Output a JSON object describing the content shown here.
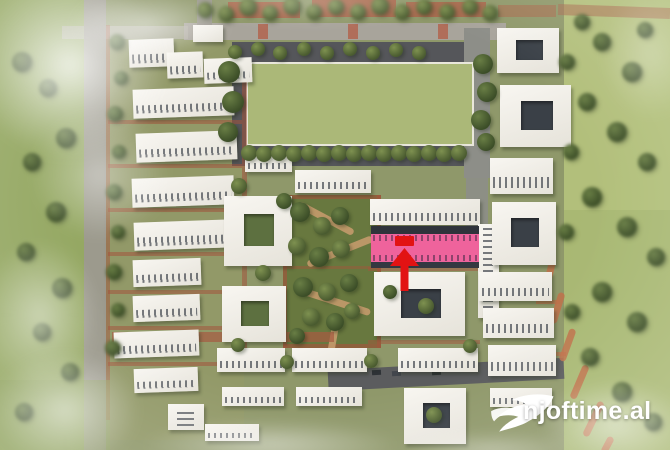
{
  "watermark": {
    "text": "njoftime.al",
    "logo": "bird-swoosh-icon",
    "color": "#ffffff"
  },
  "highlight": {
    "building_color": "#ef639c",
    "marker_color": "#e21313",
    "meaning": "highlighted-building-with-red-arrow-marker"
  },
  "palette": {
    "grass": "#9aab68",
    "sports_field": "#abb878",
    "pavement": "#55565a",
    "building_white": "#f4f1ea",
    "facade_dark": "#2f333b",
    "path_red": "#a3543c",
    "watermark_text": "#ffffff"
  },
  "scene": {
    "description": "aerial 3D render of a residential complex master plan; white apartment slabs and courtyard blocks around a central garden and a green sports field; one long building highlighted pink with a red arrow; blurred green meadows at the edges",
    "patches": [
      [
        0,
        0,
        96,
        450,
        "#95a763",
        0.9
      ],
      [
        558,
        0,
        112,
        450,
        "#a8b873",
        0.9
      ],
      [
        556,
        0,
        114,
        210,
        "#b7c37f",
        0.65
      ],
      [
        104,
        0,
        460,
        450,
        "#8f986a",
        1
      ],
      [
        108,
        40,
        136,
        400,
        "#939a68",
        0.7
      ],
      [
        228,
        2,
        72,
        16,
        "#ad6148",
        0.85
      ],
      [
        312,
        0,
        84,
        17,
        "#ad6148",
        0.85
      ],
      [
        406,
        2,
        80,
        15,
        "#ad6148",
        0.8
      ],
      [
        498,
        5,
        58,
        12,
        "#ad6148",
        0.5
      ],
      [
        558,
        6,
        112,
        11,
        "#a96a4f",
        0.55,
        2
      ],
      [
        184,
        23,
        322,
        17,
        "#a8a49b",
        1
      ],
      [
        62,
        26,
        126,
        13,
        "#b6b2a8",
        0.65
      ],
      [
        197,
        0,
        15,
        25,
        "#9a978f",
        0.9
      ],
      [
        258,
        24,
        10,
        15,
        "#b2604a",
        0.8
      ],
      [
        348,
        24,
        10,
        15,
        "#b2604a",
        0.8
      ],
      [
        438,
        24,
        10,
        15,
        "#b2604a",
        0.8
      ],
      [
        232,
        42,
        252,
        124,
        "#55565a",
        1
      ],
      [
        464,
        28,
        26,
        150,
        "#8d8e88",
        1
      ],
      [
        466,
        176,
        22,
        56,
        "#8d8e88",
        0.9
      ],
      [
        84,
        0,
        22,
        450,
        "#9c998f",
        0.95
      ],
      [
        106,
        25,
        4,
        395,
        "#a3543c",
        0.5
      ],
      [
        246,
        62,
        224,
        80,
        "#abb878",
        1,
        0,
        0,
        "#e9e7db"
      ],
      [
        108,
        120,
        134,
        4,
        "#a3543c",
        0.55
      ],
      [
        108,
        164,
        134,
        4,
        "#a3543c",
        0.55
      ],
      [
        108,
        208,
        134,
        4,
        "#a3543c",
        0.55
      ],
      [
        108,
        252,
        134,
        4,
        "#a3543c",
        0.55
      ],
      [
        108,
        290,
        134,
        4,
        "#a3543c",
        0.55
      ],
      [
        108,
        326,
        134,
        4,
        "#a3543c",
        0.55
      ],
      [
        108,
        362,
        134,
        4,
        "#a3543c",
        0.55
      ],
      [
        242,
        58,
        5,
        300,
        "#a3543c",
        0.55
      ],
      [
        283,
        195,
        98,
        153,
        "#68783f",
        1
      ],
      [
        283,
        195,
        98,
        4,
        "#a3543c",
        0.65
      ],
      [
        283,
        344,
        98,
        4,
        "#a3543c",
        0.65
      ],
      [
        283,
        195,
        4,
        153,
        "#a3543c",
        0.65
      ],
      [
        377,
        195,
        4,
        153,
        "#a3543c",
        0.65
      ],
      [
        283,
        266,
        98,
        3,
        "#a3543c",
        0.45
      ],
      [
        295,
        215,
        62,
        7,
        "#c49a6c",
        0.9,
        28,
        4
      ],
      [
        305,
        248,
        70,
        7,
        "#c49a6c",
        0.9,
        -22,
        4
      ],
      [
        298,
        298,
        74,
        7,
        "#c49a6c",
        0.9,
        18,
        4
      ],
      [
        330,
        322,
        7,
        30,
        "#c49a6c",
        0.9,
        10,
        4
      ],
      [
        328,
        364,
        236,
        21,
        "#5b5c5e",
        1,
        -3
      ],
      [
        372,
        370,
        9,
        5,
        "#2e3236",
        1,
        -3
      ],
      [
        392,
        371,
        9,
        5,
        "#42464c",
        1,
        -3
      ],
      [
        432,
        370,
        9,
        5,
        "#2e3236",
        1,
        -3
      ],
      [
        112,
        332,
        222,
        10,
        "#a65a41",
        0.7
      ],
      [
        368,
        267,
        112,
        4,
        "#a3543c",
        0.5
      ],
      [
        368,
        340,
        112,
        4,
        "#a3543c",
        0.5
      ],
      [
        546,
        260,
        7,
        28,
        "#c0714a",
        0.85,
        14,
        4
      ],
      [
        554,
        292,
        7,
        32,
        "#c0714a",
        0.85,
        17,
        4
      ],
      [
        564,
        328,
        7,
        34,
        "#c0714a",
        0.85,
        20,
        4
      ],
      [
        576,
        364,
        7,
        36,
        "#c0714a",
        0.85,
        23,
        4
      ],
      [
        590,
        400,
        7,
        38,
        "#c0714a",
        0.85,
        26,
        4
      ],
      [
        604,
        436,
        7,
        18,
        "#c0714a",
        0.85,
        28,
        4
      ],
      [
        536,
        300,
        24,
        4,
        "#c0714a",
        0.7
      ],
      [
        540,
        352,
        26,
        4,
        "#c0714a",
        0.7
      ],
      [
        0,
        380,
        110,
        70,
        "#8d9f5e",
        0.5
      ]
    ],
    "buildings": [
      [
        193,
        25,
        30,
        17,
        "f",
        0
      ],
      [
        129,
        39,
        45,
        28,
        "s",
        -2
      ],
      [
        167,
        52,
        36,
        26,
        "s",
        -2
      ],
      [
        204,
        58,
        48,
        25,
        "s",
        -2
      ],
      [
        133,
        88,
        101,
        29,
        "s",
        -2
      ],
      [
        136,
        132,
        101,
        29,
        "s",
        -2
      ],
      [
        132,
        177,
        102,
        29,
        "s",
        -2
      ],
      [
        134,
        221,
        100,
        28,
        "s",
        -2
      ],
      [
        133,
        259,
        68,
        27,
        "s",
        -2
      ],
      [
        133,
        295,
        67,
        26,
        "s",
        -2
      ],
      [
        114,
        331,
        85,
        26,
        "s",
        -2
      ],
      [
        134,
        368,
        64,
        24,
        "s",
        -2
      ],
      [
        168,
        404,
        36,
        26,
        "v",
        0
      ],
      [
        205,
        424,
        54,
        17,
        "s",
        0
      ],
      [
        245,
        152,
        47,
        20,
        "s",
        0
      ],
      [
        295,
        170,
        76,
        23,
        "s",
        0
      ],
      [
        224,
        196,
        68,
        70,
        "c",
        0,
        "g"
      ],
      [
        222,
        286,
        64,
        56,
        "c",
        0,
        "g"
      ],
      [
        217,
        348,
        68,
        24,
        "s",
        0
      ],
      [
        222,
        387,
        62,
        19,
        "s",
        0
      ],
      [
        292,
        348,
        75,
        24,
        "s",
        0
      ],
      [
        296,
        387,
        66,
        19,
        "s",
        0
      ],
      [
        370,
        199,
        110,
        26,
        "s",
        0
      ],
      [
        478,
        224,
        21,
        94,
        "v",
        0
      ],
      [
        374,
        272,
        91,
        64,
        "c",
        0,
        "d"
      ],
      [
        398,
        348,
        80,
        24,
        "s",
        0
      ],
      [
        404,
        388,
        62,
        56,
        "c",
        0,
        "d"
      ],
      [
        497,
        28,
        62,
        45,
        "c",
        0,
        "d"
      ],
      [
        500,
        85,
        71,
        62,
        "c",
        0,
        "d"
      ],
      [
        490,
        158,
        63,
        36,
        "s",
        0
      ],
      [
        492,
        202,
        64,
        63,
        "c",
        0,
        "d"
      ],
      [
        479,
        272,
        73,
        29,
        "s",
        0
      ],
      [
        483,
        308,
        71,
        30,
        "s",
        0
      ],
      [
        488,
        345,
        68,
        31,
        "s",
        0
      ],
      [
        490,
        388,
        62,
        19,
        "s",
        0
      ]
    ],
    "trees": [
      [
        205,
        10,
        8,
        1,
        0
      ],
      [
        226,
        14,
        8,
        1,
        0
      ],
      [
        248,
        7,
        9,
        1,
        0
      ],
      [
        270,
        13,
        8,
        1,
        0
      ],
      [
        292,
        6,
        9,
        1,
        0
      ],
      [
        314,
        12,
        8,
        1,
        0
      ],
      [
        336,
        7,
        8,
        1,
        0
      ],
      [
        358,
        12,
        8,
        1,
        0
      ],
      [
        380,
        6,
        9,
        1,
        0
      ],
      [
        402,
        12,
        8,
        1,
        0
      ],
      [
        424,
        7,
        8,
        1,
        0
      ],
      [
        447,
        12,
        8,
        1,
        0
      ],
      [
        470,
        7,
        8,
        1,
        0
      ],
      [
        490,
        13,
        8,
        1,
        0
      ],
      [
        235,
        52,
        7,
        0,
        0
      ],
      [
        258,
        49,
        7,
        0,
        0
      ],
      [
        280,
        53,
        7,
        0,
        0
      ],
      [
        304,
        49,
        7,
        0,
        0
      ],
      [
        327,
        53,
        7,
        0,
        0
      ],
      [
        350,
        49,
        7,
        0,
        0
      ],
      [
        373,
        53,
        7,
        0,
        0
      ],
      [
        396,
        50,
        7,
        0,
        0
      ],
      [
        419,
        53,
        7,
        0,
        0
      ],
      [
        249,
        153,
        8,
        0,
        0
      ],
      [
        264,
        154,
        8,
        0,
        0
      ],
      [
        279,
        153,
        8,
        0,
        0
      ],
      [
        294,
        154,
        8,
        0,
        0
      ],
      [
        309,
        153,
        8,
        0,
        0
      ],
      [
        324,
        154,
        8,
        0,
        0
      ],
      [
        339,
        153,
        8,
        0,
        0
      ],
      [
        354,
        154,
        8,
        0,
        0
      ],
      [
        369,
        153,
        8,
        0,
        0
      ],
      [
        384,
        154,
        8,
        0,
        0
      ],
      [
        399,
        153,
        8,
        0,
        0
      ],
      [
        414,
        154,
        8,
        0,
        0
      ],
      [
        429,
        153,
        8,
        0,
        0
      ],
      [
        444,
        154,
        8,
        0,
        0
      ],
      [
        459,
        153,
        8,
        0,
        0
      ],
      [
        229,
        72,
        11,
        0,
        1
      ],
      [
        233,
        102,
        11,
        0,
        1
      ],
      [
        228,
        132,
        10,
        0,
        1
      ],
      [
        483,
        64,
        10,
        0,
        1
      ],
      [
        487,
        92,
        10,
        0,
        1
      ],
      [
        481,
        120,
        10,
        0,
        1
      ],
      [
        486,
        142,
        9,
        0,
        1
      ],
      [
        117,
        42,
        8,
        1,
        1
      ],
      [
        121,
        78,
        7,
        1,
        1
      ],
      [
        115,
        114,
        8,
        1,
        1
      ],
      [
        119,
        152,
        7,
        1,
        1
      ],
      [
        114,
        192,
        8,
        1,
        1
      ],
      [
        118,
        232,
        7,
        1,
        1
      ],
      [
        114,
        272,
        8,
        1,
        1
      ],
      [
        118,
        310,
        7,
        1,
        1
      ],
      [
        113,
        348,
        8,
        1,
        1
      ],
      [
        22,
        62,
        10,
        1,
        1
      ],
      [
        48,
        88,
        9,
        1,
        1
      ],
      [
        66,
        138,
        10,
        1,
        1
      ],
      [
        32,
        162,
        9,
        1,
        1
      ],
      [
        56,
        212,
        10,
        1,
        1
      ],
      [
        26,
        252,
        9,
        1,
        1
      ],
      [
        62,
        288,
        10,
        1,
        1
      ],
      [
        42,
        332,
        9,
        1,
        1
      ],
      [
        70,
        372,
        9,
        1,
        1
      ],
      [
        24,
        412,
        9,
        1,
        1
      ],
      [
        300,
        212,
        10,
        0,
        1
      ],
      [
        322,
        226,
        9,
        0,
        0
      ],
      [
        340,
        216,
        9,
        0,
        1
      ],
      [
        297,
        246,
        9,
        0,
        0
      ],
      [
        319,
        257,
        10,
        0,
        1
      ],
      [
        341,
        249,
        9,
        0,
        0
      ],
      [
        303,
        287,
        10,
        0,
        1
      ],
      [
        327,
        292,
        9,
        0,
        0
      ],
      [
        349,
        283,
        9,
        0,
        1
      ],
      [
        311,
        317,
        9,
        0,
        0
      ],
      [
        335,
        322,
        9,
        0,
        1
      ],
      [
        352,
        311,
        8,
        0,
        0
      ],
      [
        297,
        336,
        8,
        0,
        1
      ],
      [
        239,
        186,
        8,
        0,
        0
      ],
      [
        284,
        201,
        8,
        0,
        1
      ],
      [
        263,
        273,
        8,
        0,
        0
      ],
      [
        238,
        345,
        7,
        0,
        0
      ],
      [
        426,
        306,
        8,
        0,
        0
      ],
      [
        434,
        415,
        8,
        0,
        0
      ],
      [
        390,
        292,
        7,
        0,
        1
      ],
      [
        470,
        346,
        7,
        0,
        0
      ],
      [
        287,
        362,
        7,
        0,
        0
      ],
      [
        371,
        361,
        7,
        0,
        0
      ],
      [
        602,
        42,
        9,
        1,
        1
      ],
      [
        632,
        72,
        10,
        1,
        1
      ],
      [
        587,
        102,
        9,
        1,
        1
      ],
      [
        617,
        132,
        10,
        1,
        1
      ],
      [
        647,
        162,
        9,
        1,
        1
      ],
      [
        592,
        197,
        10,
        1,
        1
      ],
      [
        627,
        227,
        10,
        1,
        1
      ],
      [
        656,
        257,
        9,
        1,
        1
      ],
      [
        602,
        292,
        10,
        1,
        1
      ],
      [
        637,
        322,
        10,
        1,
        1
      ],
      [
        590,
        357,
        9,
        1,
        1
      ],
      [
        622,
        392,
        10,
        1,
        1
      ],
      [
        653,
        422,
        9,
        1,
        1
      ],
      [
        567,
        62,
        8,
        1,
        1
      ],
      [
        571,
        152,
        8,
        1,
        1
      ],
      [
        566,
        232,
        8,
        1,
        1
      ],
      [
        572,
        312,
        8,
        1,
        1
      ],
      [
        582,
        22,
        8,
        1,
        1
      ],
      [
        645,
        30,
        8,
        1,
        1
      ]
    ],
    "fog": [
      [
        -30,
        -30,
        200,
        190,
        0.85
      ],
      [
        30,
        110,
        140,
        130,
        0.45
      ],
      [
        -20,
        240,
        120,
        150,
        0.5
      ],
      [
        -10,
        350,
        150,
        120,
        0.6
      ],
      [
        140,
        420,
        260,
        50,
        0.5
      ],
      [
        400,
        432,
        180,
        36,
        0.4
      ],
      [
        540,
        380,
        150,
        90,
        0.55
      ],
      [
        600,
        -10,
        100,
        130,
        0.3
      ],
      [
        180,
        -20,
        260,
        45,
        0.3
      ],
      [
        70,
        -10,
        160,
        70,
        0.6
      ]
    ]
  }
}
